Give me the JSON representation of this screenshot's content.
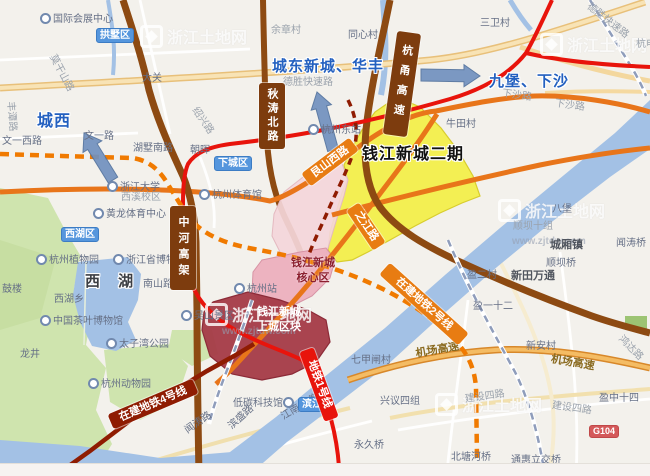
{
  "watermark": {
    "site_name": "浙江土地网",
    "site_url": "www.zjtdw.com"
  },
  "region_labels": {
    "chengxi": "城西",
    "chengdong": "城东新城、华丰",
    "jiubao": "九堡、下沙",
    "xihu": "西 湖",
    "qjnc_phase2": "钱江新城二期"
  },
  "zones": {
    "core_line1": "钱江新城",
    "core_line2": "核心区",
    "shangcheng_line1": "钱江新城",
    "shangcheng_line2": "上城区块"
  },
  "district_badges": [
    {
      "label": "拱墅区"
    },
    {
      "label": "下城区"
    },
    {
      "label": "西湖区"
    },
    {
      "label": "滨江"
    }
  ],
  "road_banners": [
    {
      "label": "秋涛北路"
    },
    {
      "label": "杭甬高速"
    },
    {
      "label": "中河高架"
    },
    {
      "label": "艮山西路"
    },
    {
      "label": "之江路"
    }
  ],
  "metro_banners": [
    {
      "label": "在建地铁4号线"
    },
    {
      "label": "地铁1号线"
    },
    {
      "label": "在建地铁2号线"
    }
  ],
  "highway_badge": "G104",
  "colors": {
    "metro_line1_red": "#e8140c",
    "metro_line2_orange": "#f07a00",
    "metro_line4_maroon": "#8f1c02",
    "zone_yellow": "#f2ef47",
    "zone_pink_light": "#f4d6da",
    "zone_pink_core": "#ecaebc",
    "zone_dark_red": "#a43a47",
    "district_badge_blue": "#5596dd",
    "annotation_blue": "#2360c0",
    "water_blue": "#a3c1e5"
  },
  "pois": [
    {
      "label": "国际会展中心",
      "x": 40,
      "y": 13,
      "icon": true
    },
    {
      "label": "大关",
      "x": 142,
      "y": 73
    },
    {
      "label": "余章村",
      "x": 271,
      "y": 25,
      "cls": "faint"
    },
    {
      "label": "同心村",
      "x": 348,
      "y": 30
    },
    {
      "label": "三卫村",
      "x": 480,
      "y": 18
    },
    {
      "label": "德胜快速路",
      "x": 283,
      "y": 77,
      "cls": "faint"
    },
    {
      "label": "德胜快速路",
      "x": 588,
      "y": 0,
      "rot": 38,
      "cls": "faint"
    },
    {
      "label": "杭电",
      "x": 636,
      "y": 39,
      "cls": "faint"
    },
    {
      "label": "莫干山路",
      "x": 52,
      "y": 50,
      "rot": 62,
      "cls": "faint"
    },
    {
      "label": "丰潭路",
      "x": 10,
      "y": 96,
      "rot": 85,
      "cls": "faint"
    },
    {
      "label": "文一西路",
      "x": 2,
      "y": 136
    },
    {
      "label": "文一路",
      "x": 84,
      "y": 131
    },
    {
      "label": "湖墅南路",
      "x": 133,
      "y": 143
    },
    {
      "label": "朝晖",
      "x": 190,
      "y": 145
    },
    {
      "label": "绍兴路",
      "x": 194,
      "y": 103,
      "rot": 55,
      "cls": "faint"
    },
    {
      "label": "浙江大学",
      "x": 107,
      "y": 181,
      "icon": true
    },
    {
      "label": "西溪校区",
      "x": 121,
      "y": 192,
      "cls": "faint"
    },
    {
      "label": "黄龙体育中心",
      "x": 93,
      "y": 208,
      "icon": true
    },
    {
      "label": "杭州体育馆",
      "x": 199,
      "y": 189,
      "icon": true
    },
    {
      "label": "杭州植物园",
      "x": 36,
      "y": 254,
      "icon": true
    },
    {
      "label": "浙江省博物馆",
      "x": 113,
      "y": 254,
      "icon": true
    },
    {
      "label": "南山路",
      "x": 143,
      "y": 279
    },
    {
      "label": "西湖乡",
      "x": 54,
      "y": 294
    },
    {
      "label": "鼓楼",
      "x": 2,
      "y": 284
    },
    {
      "label": "中国茶叶博物馆",
      "x": 40,
      "y": 315,
      "icon": true
    },
    {
      "label": "吴山景区",
      "x": 181,
      "y": 310,
      "icon": true
    },
    {
      "label": "太子湾公园",
      "x": 106,
      "y": 338,
      "icon": true
    },
    {
      "label": "龙井",
      "x": 20,
      "y": 349
    },
    {
      "label": "杭州动物园",
      "x": 88,
      "y": 378,
      "icon": true
    },
    {
      "label": "杭州站",
      "x": 234,
      "y": 283,
      "icon": true
    },
    {
      "label": "杭州东站",
      "x": 308,
      "y": 124,
      "icon": true
    },
    {
      "label": "牛田村",
      "x": 446,
      "y": 119
    },
    {
      "label": "下沙路",
      "x": 502,
      "y": 88,
      "rot": 8,
      "cls": "faint"
    },
    {
      "label": "下沙路",
      "x": 555,
      "y": 98,
      "rot": 8,
      "cls": "faint"
    },
    {
      "label": "八堡",
      "x": 552,
      "y": 204
    },
    {
      "label": "顺坝十组",
      "x": 513,
      "y": 221,
      "cls": "faint"
    },
    {
      "label": "城厢镇",
      "x": 550,
      "y": 240,
      "cls": "dark"
    },
    {
      "label": "顺坝桥",
      "x": 546,
      "y": 258
    },
    {
      "label": "闻涛桥",
      "x": 616,
      "y": 238
    },
    {
      "label": "新田万通",
      "x": 511,
      "y": 271,
      "cls": "dark"
    },
    {
      "label": "盈二村",
      "x": 467,
      "y": 270
    },
    {
      "label": "盈一十二",
      "x": 473,
      "y": 301
    },
    {
      "label": "新安村",
      "x": 526,
      "y": 341
    },
    {
      "label": "七甲闸村",
      "x": 351,
      "y": 355
    },
    {
      "label": "兴议四组",
      "x": 380,
      "y": 396
    },
    {
      "label": "永久桥",
      "x": 354,
      "y": 440
    },
    {
      "label": "盈中十四",
      "x": 599,
      "y": 393
    },
    {
      "label": "建设四路",
      "x": 465,
      "y": 394,
      "rot": -8,
      "cls": "faint"
    },
    {
      "label": "建设四路",
      "x": 552,
      "y": 400,
      "rot": 8,
      "cls": "faint"
    },
    {
      "label": "北塘河桥",
      "x": 451,
      "y": 452
    },
    {
      "label": "通惠立交桥",
      "x": 511,
      "y": 455
    },
    {
      "label": "机场高速",
      "x": 416,
      "y": 349,
      "rot": -10,
      "cls": "road"
    },
    {
      "label": "机场高速",
      "x": 551,
      "y": 354,
      "rot": 10,
      "cls": "road"
    },
    {
      "label": "鸿达路",
      "x": 620,
      "y": 332,
      "rot": 45,
      "cls": "faint"
    },
    {
      "label": "闻涛路",
      "x": 186,
      "y": 426,
      "rot": -35
    },
    {
      "label": "滨盛路",
      "x": 230,
      "y": 422,
      "rot": -42
    },
    {
      "label": "江南大道",
      "x": 282,
      "y": 412,
      "rot": -30
    },
    {
      "label": "低碳科技馆",
      "x": 233,
      "y": 397,
      "icon": "after"
    }
  ]
}
